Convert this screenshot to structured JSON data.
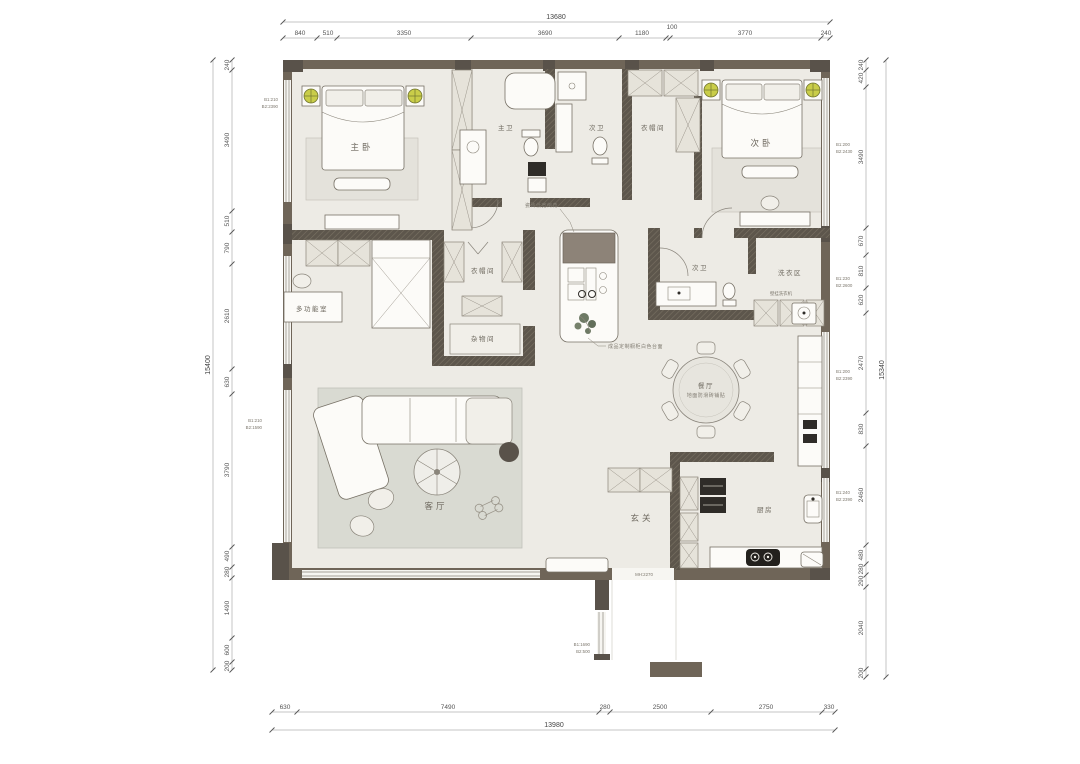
{
  "dims": {
    "top": {
      "total": "13680",
      "segs": [
        "840",
        "510",
        "3350",
        "3690",
        "1180",
        "100",
        "3770",
        "240"
      ]
    },
    "bottom": {
      "total": "13980",
      "segs": [
        "630",
        "7490",
        "280",
        "2500",
        "2750",
        "330"
      ]
    },
    "left": {
      "total": "15400",
      "segs": [
        "240",
        "3490",
        "510",
        "790",
        "2610",
        "630",
        "3790",
        "490",
        "280",
        "1490",
        "600",
        "200"
      ]
    },
    "right": {
      "total": "15340",
      "segs": [
        "240",
        "420",
        "3490",
        "670",
        "810",
        "620",
        "2470",
        "830",
        "2460",
        "480",
        "280",
        "290",
        "2040",
        "200"
      ]
    }
  },
  "rooms": {
    "master_bedroom": "主卧",
    "master_bath": "主卫",
    "bath_top": "次卫",
    "cloak_top": "衣帽间",
    "second_bedroom": "次卧",
    "multifunction": "多功能室",
    "cloak_mid": "衣帽间",
    "storage": "杂物间",
    "bath_mid": "次卫",
    "laundry": "洗衣区",
    "dining": "餐厅",
    "dining_note": "地面防滑砖铺贴",
    "living": "客厅",
    "entry": "玄关",
    "kitchen": "厨房"
  },
  "annotations": {
    "island_top": "瓷砖低宽倒角",
    "island_bottom": "成品定制橱柜白色台面",
    "washer": "壁挂洗衣机",
    "entry_door": "MH:2270",
    "stub": [
      "B1:1690",
      "B2:500"
    ],
    "win_left_top": [
      "B1:210",
      "B2:2390"
    ],
    "win_left_mid": [
      "B1:210",
      "B2:1590"
    ],
    "win_right_1": [
      "B1:200",
      "B2:2430"
    ],
    "win_right_2": [
      "B1:230",
      "B2:2600"
    ],
    "win_right_3": [
      "B1:200",
      "B2:2390"
    ],
    "win_right_4": [
      "B1:240",
      "B2:2390"
    ]
  },
  "colors": {
    "wall": "#6f6558",
    "wall_dark": "#59524a",
    "floor": "#edebe5",
    "rug": "#d9dad2",
    "lamp": "#c9cd49",
    "counter": "#8d8378",
    "appliance": "#2f2c28",
    "dim_text": "#555555"
  }
}
